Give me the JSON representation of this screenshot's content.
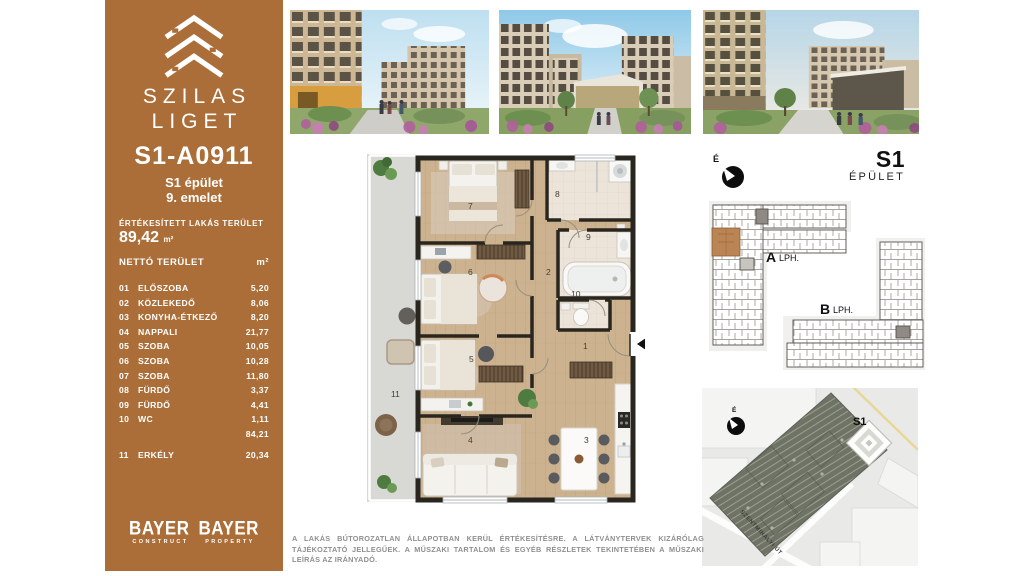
{
  "sidebar": {
    "brand_line1": "SZILAS",
    "brand_line2": "LIGET",
    "unit_id": "S1-A0911",
    "building_line": "S1 épület",
    "floor_line": "9. emelet",
    "sold_area_label": "ÉRTÉKESÍTETT LAKÁS TERÜLET",
    "sold_area_value": "89,42",
    "area_unit": "m²",
    "net_area_label": "NETTÓ TERÜLET",
    "net_area_unit": "m²",
    "rooms": [
      {
        "num": "01",
        "name": "ELŐSZOBA",
        "area": "5,20"
      },
      {
        "num": "02",
        "name": "KÖZLEKEDŐ",
        "area": "8,06"
      },
      {
        "num": "03",
        "name": "KONYHA-ÉTKEZŐ",
        "area": "8,20"
      },
      {
        "num": "04",
        "name": "NAPPALI",
        "area": "21,77"
      },
      {
        "num": "05",
        "name": "SZOBA",
        "area": "10,05"
      },
      {
        "num": "06",
        "name": "SZOBA",
        "area": "10,28"
      },
      {
        "num": "07",
        "name": "SZOBA",
        "area": "11,80"
      },
      {
        "num": "08",
        "name": "FÜRDŐ",
        "area": "3,37"
      },
      {
        "num": "09",
        "name": "FÜRDŐ",
        "area": "4,41"
      },
      {
        "num": "10",
        "name": "WC",
        "area": "1,11"
      }
    ],
    "net_total": "84,21",
    "balcony": {
      "num": "11",
      "name": "ERKÉLY",
      "area": "20,34"
    },
    "logos": [
      {
        "name": "BAYER",
        "division": "CONSTRUCT"
      },
      {
        "name": "BAYER",
        "division": "PROPERTY"
      }
    ],
    "accent_color": "#ab6e38"
  },
  "floor_plan": {
    "labels": {
      "r1": "1",
      "r2": "2",
      "r3": "3",
      "r4": "4",
      "r5": "5",
      "r6": "6",
      "r7": "7",
      "r8": "8",
      "r9": "9",
      "r10": "10",
      "r11": "11"
    }
  },
  "right_panel": {
    "compass_label": "É",
    "building_code": "S1",
    "building_word": "ÉPÜLET",
    "keyplan": {
      "stair_a_letter": "A",
      "stair_a_word": "LPH.",
      "stair_b_letter": "B",
      "stair_b_word": "LPH.",
      "highlight_color": "#bb8453"
    },
    "sitemap": {
      "building_label": "S1",
      "street_label": "SZENTMIHÁLYI ÚT",
      "compass_label": "É"
    }
  },
  "disclaimer": {
    "text": "A LAKÁS BÚTOROZATLAN ÁLLAPOTBAN KERÜL ÉRTÉKESÍTÉSRE. A LÁTVÁNYTERVEK KIZÁRÓLAG TÁJÉKOZTATÓ JELLEGŰEK. A MŰSZAKI TARTALOM ÉS EGYÉB RÉSZLETEK TEKINTETÉBEN A MŰSZAKI LEÍRÁS AZ IRÁNYADÓ."
  }
}
